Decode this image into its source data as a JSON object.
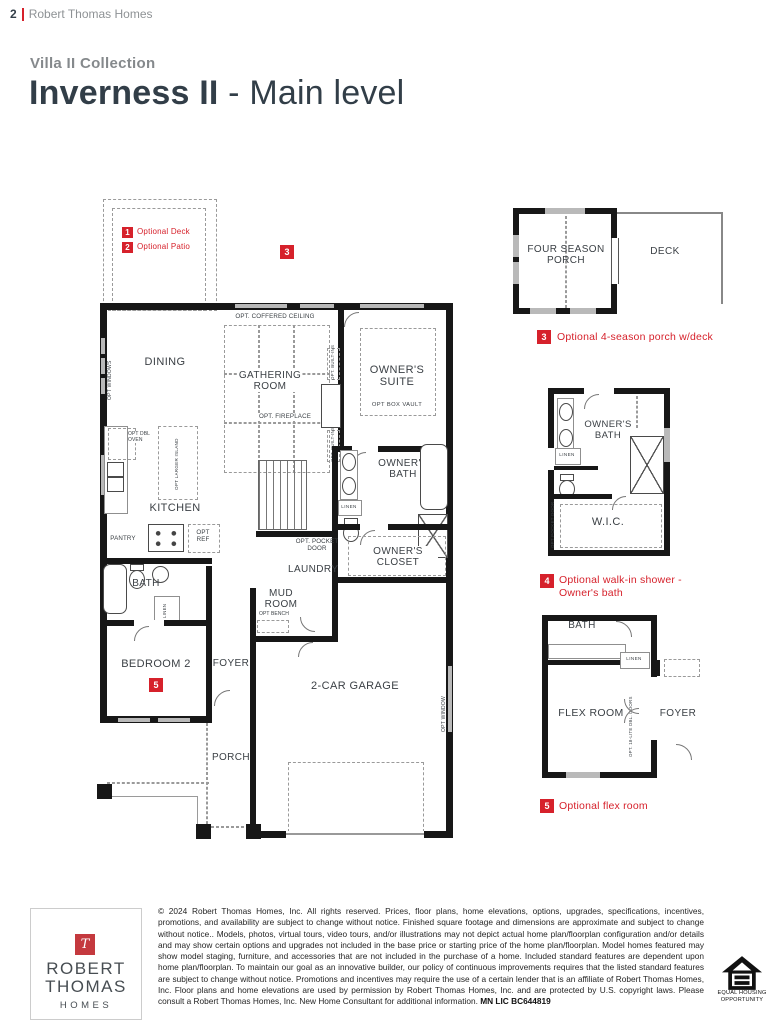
{
  "colors": {
    "accent_red": "#d6212b",
    "ink": "#323e48",
    "gray": "#8e9295",
    "wall": "#171717"
  },
  "header": {
    "page_number": "2",
    "brand": "Robert Thomas Homes"
  },
  "title": {
    "collection": "Villa II Collection",
    "name": "Inverness II",
    "suffix": " - Main level"
  },
  "plan": {
    "legend": [
      {
        "num": "1",
        "label": "Optional Deck"
      },
      {
        "num": "2",
        "label": "Optional Patio"
      }
    ],
    "badge_3": "3",
    "badge_5": "5",
    "labels": {
      "opt_windows": "OPT WINDOWS",
      "dining": "DINING",
      "opt_coffered_ceiling": "OPT. COFFERED CEILING",
      "gathering_room": "GATHERING ROOM",
      "owners_suite": "OWNER'S SUITE",
      "opt_box_vault": "OPT BOX VAULT",
      "opt_fireplace": "OPT. FIREPLACE",
      "opt_built_ins": "OPT. BUILT-INS",
      "opt_dbl_oven": "OPT DBL OVEN",
      "opt_larger_island": "OPT LARGER ISLAND",
      "kitchen": "KITCHEN",
      "pantry": "PANTRY",
      "opt_ref": "OPT REF",
      "owners_bath": "OWNER'S BATH",
      "linen": "LINEN",
      "opt_pocket_door": "OPT. POCKET DOOR",
      "laundry": "LAUNDRY",
      "owners_closet": "OWNER'S CLOSET",
      "bath": "BATH",
      "mud_room": "MUD ROOM",
      "opt_bench": "OPT BENCH",
      "bedroom_2": "BEDROOM 2",
      "foyer": "FOYER",
      "garage": "2-CAR GARAGE",
      "porch": "PORCH",
      "opt_window": "OPT WINDOW"
    }
  },
  "inset_porch": {
    "badge": "3",
    "room": "FOUR SEASON PORCH",
    "deck": "DECK",
    "caption": "Optional 4-season porch w/deck"
  },
  "inset_bath": {
    "badge": "4",
    "room": "OWNER'S BATH",
    "linen": "LINEN",
    "wic": "W.I.C.",
    "opt_pocket_door": "OPT POCKET DOOR",
    "caption_1": "Optional walk-in shower -",
    "caption_2": "Owner's bath"
  },
  "inset_flex": {
    "badge": "5",
    "bath": "BATH",
    "linen": "LINEN",
    "flex": "FLEX ROOM",
    "foyer": "FOYER",
    "opt_doors": "OPT. 18-LITE DBL. DOORS",
    "caption": "Optional flex room"
  },
  "footer": {
    "logo": {
      "monogram": "T",
      "name_1": "ROBERT",
      "name_2": "THOMAS",
      "name_3": "HOMES"
    },
    "legal": "© 2024 Robert Thomas Homes, Inc. All rights reserved. Prices, floor plans, home elevations, options, upgrades, specifications, incentives, promotions, and availability are subject to change without notice. Finished square footage and dimensions are approximate and subject to change without notice.. Models, photos, virtual tours, video tours, and/or illustrations may not depict actual home plan/floorplan configuration and/or details and may show certain options and upgrades not included in the base price or starting price of the home plan/floorplan. Model homes featured may show model staging, furniture, and accessories that are not included in the purchase of a home. Included standard features are dependent upon home plan/floorplan. To maintain our goal as an innovative builder, our policy of continuous improvements requires that the listed standard features are subject to change without notice. Promotions and incentives may require the use of a certain lender that is an affiliate of Robert Thomas Homes, Inc. Floor plans and home elevations are used by permission by Robert Thomas Homes, Inc. and are protected by U.S. copyright laws. Please consult a Robert Thomas Homes, Inc. New Home Consultant for additional information. ",
    "license": "MN LIC BC644819",
    "eho_1": "EQUAL HOUSING",
    "eho_2": "OPPORTUNITY"
  }
}
